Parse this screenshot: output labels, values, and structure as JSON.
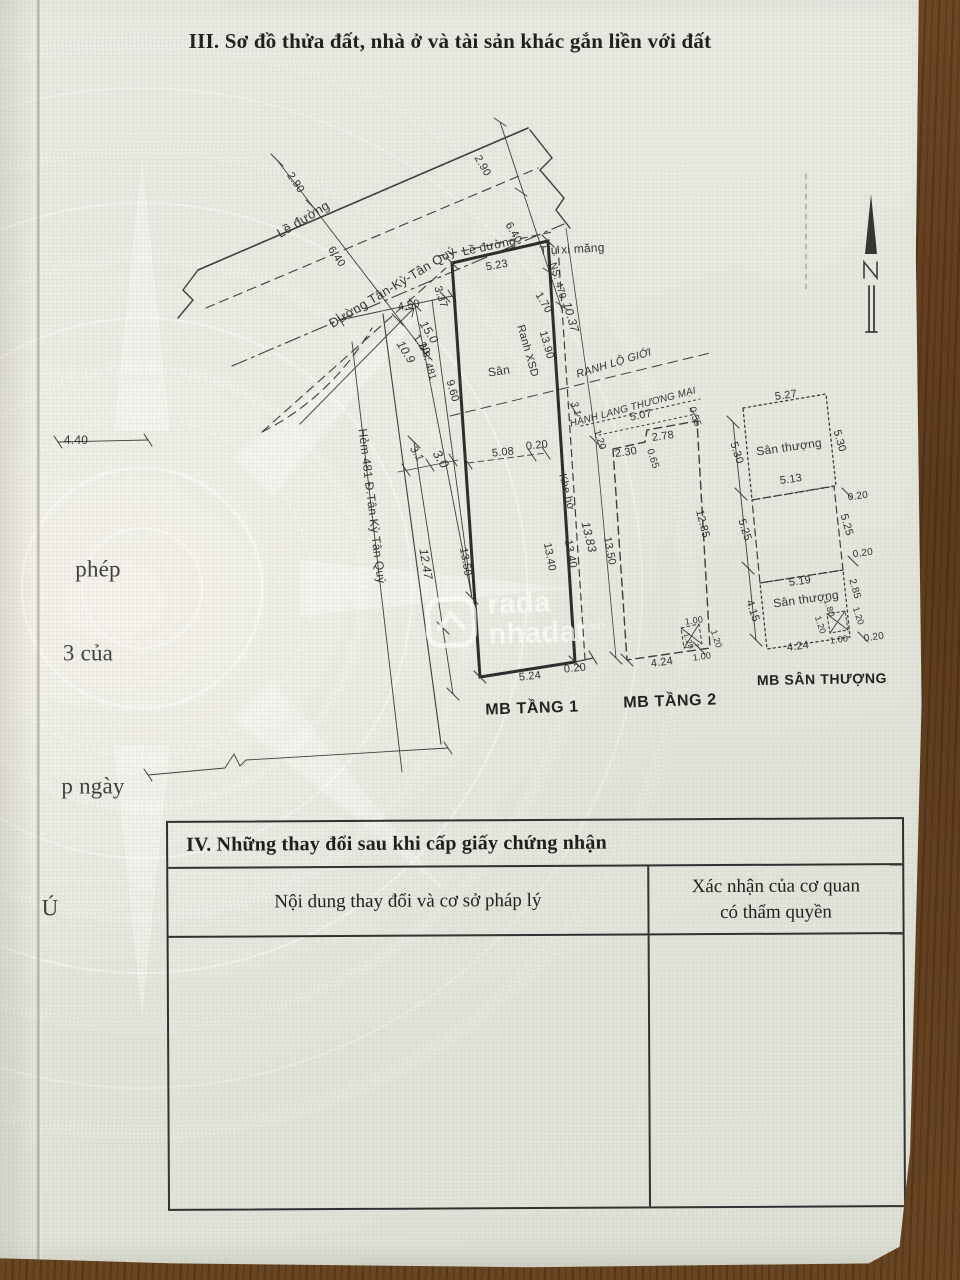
{
  "document": {
    "section_iii": {
      "title": "III. Sơ đồ thửa đất, nhà ở và tài sản khác gắn liền với đất"
    },
    "section_iv": {
      "title": "IV. Những thay đổi sau khi cấp giấy chứng nhận",
      "columns": [
        {
          "label": "Nội dung thay đổi và cơ sở pháp lý"
        },
        {
          "label": "Xác nhận của cơ quan có thẩm quyền"
        }
      ]
    },
    "watermark": {
      "brand_part1": "rada",
      "brand_part2": "nhadat",
      "brand_suffix": ".vn"
    }
  },
  "diagram": {
    "plan_titles": [
      "MB TẦNG 1",
      "MB TẦNG 2",
      "MB SÂN THƯỢNG"
    ],
    "labels": [
      {
        "t": "Lề đường",
        "x": 303,
        "y": 219,
        "r": -31,
        "s": 13,
        "c": "n"
      },
      {
        "t": "Đường Tân-Kỳ-Tân Quý",
        "x": 392,
        "y": 287,
        "r": -31,
        "s": 13,
        "c": "n"
      },
      {
        "t": "2.90",
        "x": 295,
        "y": 183,
        "r": 56,
        "s": 11,
        "c": "d"
      },
      {
        "t": "6.40",
        "x": 336,
        "y": 257,
        "r": 56,
        "s": 11,
        "c": "d"
      },
      {
        "t": "1.20",
        "x": 421,
        "y": 345,
        "r": 56,
        "s": 11,
        "c": "d"
      },
      {
        "t": "2.90",
        "x": 482,
        "y": 166,
        "r": 60,
        "s": 11,
        "c": "d"
      },
      {
        "t": "6.40",
        "x": 513,
        "y": 233,
        "r": 60,
        "s": 11,
        "c": "d"
      },
      {
        "t": "1.70",
        "x": 543,
        "y": 303,
        "r": 60,
        "s": 11,
        "c": "d"
      },
      {
        "t": "Lề đường",
        "x": 489,
        "y": 246,
        "r": -12,
        "s": 12,
        "c": "n"
      },
      {
        "t": "5.23",
        "x": 497,
        "y": 266,
        "r": -10,
        "s": 11,
        "c": "d"
      },
      {
        "t": "Trụ xi măng",
        "x": 572,
        "y": 249,
        "r": -3,
        "s": 12,
        "c": "n"
      },
      {
        "t": "3.37",
        "x": 440,
        "y": 297,
        "r": 72,
        "s": 11,
        "c": "d"
      },
      {
        "t": "4.50",
        "x": 409,
        "y": 306,
        "r": -10,
        "s": 11,
        "c": "d"
      },
      {
        "t": "15.0",
        "x": 429,
        "y": 332,
        "r": 58,
        "s": 12,
        "c": "h"
      },
      {
        "t": "10.9",
        "x": 406,
        "y": 352,
        "r": 58,
        "s": 12,
        "c": "h"
      },
      {
        "t": "NS: 481",
        "x": 427,
        "y": 362,
        "r": 74,
        "s": 10,
        "c": "d"
      },
      {
        "t": "9.60",
        "x": 452,
        "y": 391,
        "r": 74,
        "s": 11,
        "c": "d"
      },
      {
        "t": "4.40",
        "x": 76,
        "y": 440,
        "r": 0,
        "s": 12,
        "c": "d"
      },
      {
        "t": "Hẻm 481 Đ.Tân Kỳ Tân Quý",
        "x": 372,
        "y": 506,
        "r": 83,
        "s": 12,
        "c": "n"
      },
      {
        "t": "12.47",
        "x": 426,
        "y": 564,
        "r": 80,
        "s": 12,
        "c": "h"
      },
      {
        "t": "13.50",
        "x": 465,
        "y": 562,
        "r": 80,
        "s": 11,
        "c": "d"
      },
      {
        "t": "3.1",
        "x": 416,
        "y": 454,
        "r": 58,
        "s": 11,
        "c": "h"
      },
      {
        "t": "3.0",
        "x": 441,
        "y": 459,
        "r": 58,
        "s": 13,
        "c": "h"
      },
      {
        "t": "5.08",
        "x": 503,
        "y": 453,
        "r": -6,
        "s": 11,
        "c": "d"
      },
      {
        "t": "0.20",
        "x": 537,
        "y": 446,
        "r": -6,
        "s": 11,
        "c": "d"
      },
      {
        "t": "Sân",
        "x": 499,
        "y": 371,
        "r": -8,
        "s": 12,
        "c": "n"
      },
      {
        "t": "Ranh XSD",
        "x": 527,
        "y": 351,
        "r": 74,
        "s": 11,
        "c": "d"
      },
      {
        "t": "13.90",
        "x": 546,
        "y": 345,
        "r": 74,
        "s": 11,
        "c": "d"
      },
      {
        "t": "NS: 479",
        "x": 557,
        "y": 281,
        "r": 74,
        "s": 10,
        "c": "d"
      },
      {
        "t": "10.37",
        "x": 571,
        "y": 317,
        "r": 74,
        "s": 12,
        "c": "h"
      },
      {
        "t": "RANH LỘ GIỚI",
        "x": 614,
        "y": 364,
        "r": -17,
        "s": 11,
        "c": "h"
      },
      {
        "t": "HÀNH LANG THƯƠNG MẠI",
        "x": 633,
        "y": 408,
        "r": -15,
        "s": 10,
        "c": "h"
      },
      {
        "t": "Khe hở",
        "x": 566,
        "y": 492,
        "r": 76,
        "s": 11,
        "c": "n"
      },
      {
        "t": "13.40",
        "x": 549,
        "y": 557,
        "r": 79,
        "s": 11,
        "c": "d"
      },
      {
        "t": "13.40",
        "x": 570,
        "y": 554,
        "r": 79,
        "s": 11,
        "c": "d"
      },
      {
        "t": "13.83",
        "x": 589,
        "y": 537,
        "r": 76,
        "s": 12,
        "c": "h"
      },
      {
        "t": "13.50",
        "x": 609,
        "y": 551,
        "r": 79,
        "s": 11,
        "c": "d"
      },
      {
        "t": "5.24",
        "x": 530,
        "y": 677,
        "r": -6,
        "s": 11,
        "c": "d"
      },
      {
        "t": "0.20",
        "x": 575,
        "y": 669,
        "r": -6,
        "s": 11,
        "c": "d"
      },
      {
        "t": "MB TẦNG 1",
        "x": 532,
        "y": 709,
        "r": -2,
        "s": 16,
        "c": "p"
      },
      {
        "t": "3.1",
        "x": 575,
        "y": 409,
        "r": 72,
        "s": 10,
        "c": "h"
      },
      {
        "t": "5.07",
        "x": 641,
        "y": 416,
        "r": -12,
        "s": 11,
        "c": "d"
      },
      {
        "t": "0.55",
        "x": 694,
        "y": 417,
        "r": 72,
        "s": 10,
        "c": "d"
      },
      {
        "t": "1.20",
        "x": 599,
        "y": 440,
        "r": 72,
        "s": 10,
        "c": "d"
      },
      {
        "t": "2.78",
        "x": 663,
        "y": 437,
        "r": -8,
        "s": 11,
        "c": "d"
      },
      {
        "t": "2.30",
        "x": 626,
        "y": 453,
        "r": -8,
        "s": 11,
        "c": "d"
      },
      {
        "t": "0.65",
        "x": 652,
        "y": 459,
        "r": 72,
        "s": 10,
        "c": "d"
      },
      {
        "t": "12.85",
        "x": 702,
        "y": 524,
        "r": 76,
        "s": 11,
        "c": "d"
      },
      {
        "t": "1.00",
        "x": 694,
        "y": 621,
        "r": -8,
        "s": 9,
        "c": "d"
      },
      {
        "t": "1.20",
        "x": 716,
        "y": 639,
        "r": 72,
        "s": 9,
        "c": "d"
      },
      {
        "t": "1.20",
        "x": 688,
        "y": 641,
        "r": 72,
        "s": 8,
        "c": "d"
      },
      {
        "t": "4.24",
        "x": 662,
        "y": 663,
        "r": -8,
        "s": 11,
        "c": "d"
      },
      {
        "t": "1.00",
        "x": 702,
        "y": 657,
        "r": -8,
        "s": 9,
        "c": "d"
      },
      {
        "t": "MB TẦNG 2",
        "x": 670,
        "y": 702,
        "r": -2,
        "s": 16,
        "c": "p"
      },
      {
        "t": "5.30",
        "x": 736,
        "y": 453,
        "r": 72,
        "s": 11,
        "c": "d"
      },
      {
        "t": "5.25",
        "x": 744,
        "y": 530,
        "r": 72,
        "s": 11,
        "c": "d"
      },
      {
        "t": "4.15",
        "x": 752,
        "y": 611,
        "r": 72,
        "s": 11,
        "c": "d"
      },
      {
        "t": "5.27",
        "x": 786,
        "y": 396,
        "r": -8,
        "s": 11,
        "c": "d"
      },
      {
        "t": "Sân thượng",
        "x": 789,
        "y": 447,
        "r": -8,
        "s": 12,
        "c": "n"
      },
      {
        "t": "5.30",
        "x": 839,
        "y": 441,
        "r": 74,
        "s": 11,
        "c": "d"
      },
      {
        "t": "5.13",
        "x": 791,
        "y": 480,
        "r": -8,
        "s": 11,
        "c": "d"
      },
      {
        "t": "0.20",
        "x": 858,
        "y": 497,
        "r": -8,
        "s": 10,
        "c": "d"
      },
      {
        "t": "5.25",
        "x": 846,
        "y": 525,
        "r": 74,
        "s": 11,
        "c": "d"
      },
      {
        "t": "0.20",
        "x": 863,
        "y": 554,
        "r": -8,
        "s": 10,
        "c": "d"
      },
      {
        "t": "5.19",
        "x": 800,
        "y": 582,
        "r": -8,
        "s": 11,
        "c": "d"
      },
      {
        "t": "Sân thượng",
        "x": 806,
        "y": 599,
        "r": -8,
        "s": 12,
        "c": "n"
      },
      {
        "t": "2.85",
        "x": 854,
        "y": 589,
        "r": 74,
        "s": 10,
        "c": "d"
      },
      {
        "t": "1.80",
        "x": 829,
        "y": 608,
        "r": 72,
        "s": 9,
        "c": "d"
      },
      {
        "t": "1.20",
        "x": 858,
        "y": 616,
        "r": 72,
        "s": 9,
        "c": "d"
      },
      {
        "t": "1.20",
        "x": 820,
        "y": 625,
        "r": 72,
        "s": 9,
        "c": "d"
      },
      {
        "t": "1.00",
        "x": 839,
        "y": 640,
        "r": -8,
        "s": 9,
        "c": "d"
      },
      {
        "t": "0.20",
        "x": 874,
        "y": 638,
        "r": -8,
        "s": 10,
        "c": "d"
      },
      {
        "t": "4.24",
        "x": 798,
        "y": 647,
        "r": -8,
        "s": 11,
        "c": "d"
      },
      {
        "t": "MB SÂN THƯỢNG",
        "x": 822,
        "y": 679,
        "r": -1,
        "s": 14,
        "c": "p"
      },
      {
        "t": "phép",
        "x": 98,
        "y": 569,
        "r": 0,
        "s": 23,
        "c": "f"
      },
      {
        "t": "3 của",
        "x": 88,
        "y": 653,
        "r": 0,
        "s": 23,
        "c": "f"
      },
      {
        "t": "p ngày",
        "x": 93,
        "y": 786,
        "r": 0,
        "s": 23,
        "c": "f"
      },
      {
        "t": "Ú",
        "x": 50,
        "y": 908,
        "r": 0,
        "s": 23,
        "c": "f"
      }
    ]
  }
}
